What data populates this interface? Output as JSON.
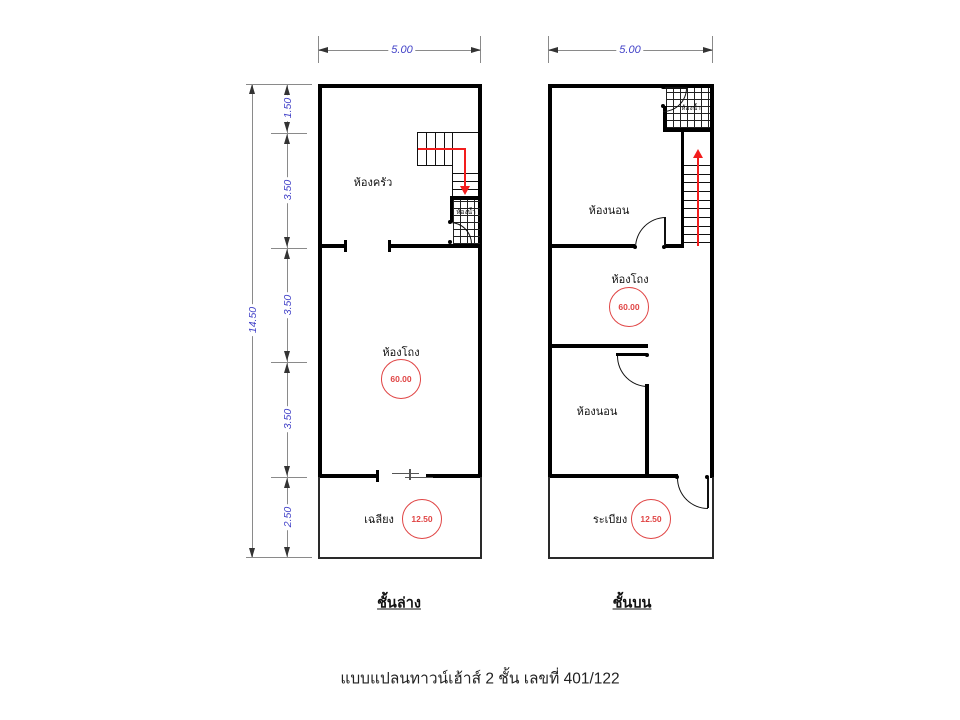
{
  "caption": "แบบแปลนทาวน์เฮ้าส์ 2 ชั้น เลขที่ 401/122",
  "colors": {
    "wall": "#000000",
    "dimension_text": "#4343c8",
    "dimension_line": "#888888",
    "area_circle": "#e04545",
    "stair_arrow": "#f21d1d"
  },
  "floor1": {
    "label": "ชั้นล่าง",
    "width_dim": "5.00",
    "height_dim_total": "14.50",
    "height_dim_segments": [
      "1.50",
      "3.50",
      "3.50",
      "3.50",
      "2.50"
    ],
    "rooms": {
      "kitchen": "ห้องครัว",
      "bathroom": "ห้องน้ำ",
      "hall": "ห้องโถง",
      "hall_area": "60.00",
      "porch": "เฉลียง",
      "porch_area": "12.50"
    }
  },
  "floor2": {
    "label": "ชั้นบน",
    "width_dim": "5.00",
    "rooms": {
      "bedroom_front": "ห้องนอน",
      "bathroom": "ห้องน้ำ",
      "hall": "ห้องโถง",
      "hall_area": "60.00",
      "bedroom_back": "ห้องนอน",
      "balcony": "ระเบียง",
      "balcony_area": "12.50"
    }
  }
}
